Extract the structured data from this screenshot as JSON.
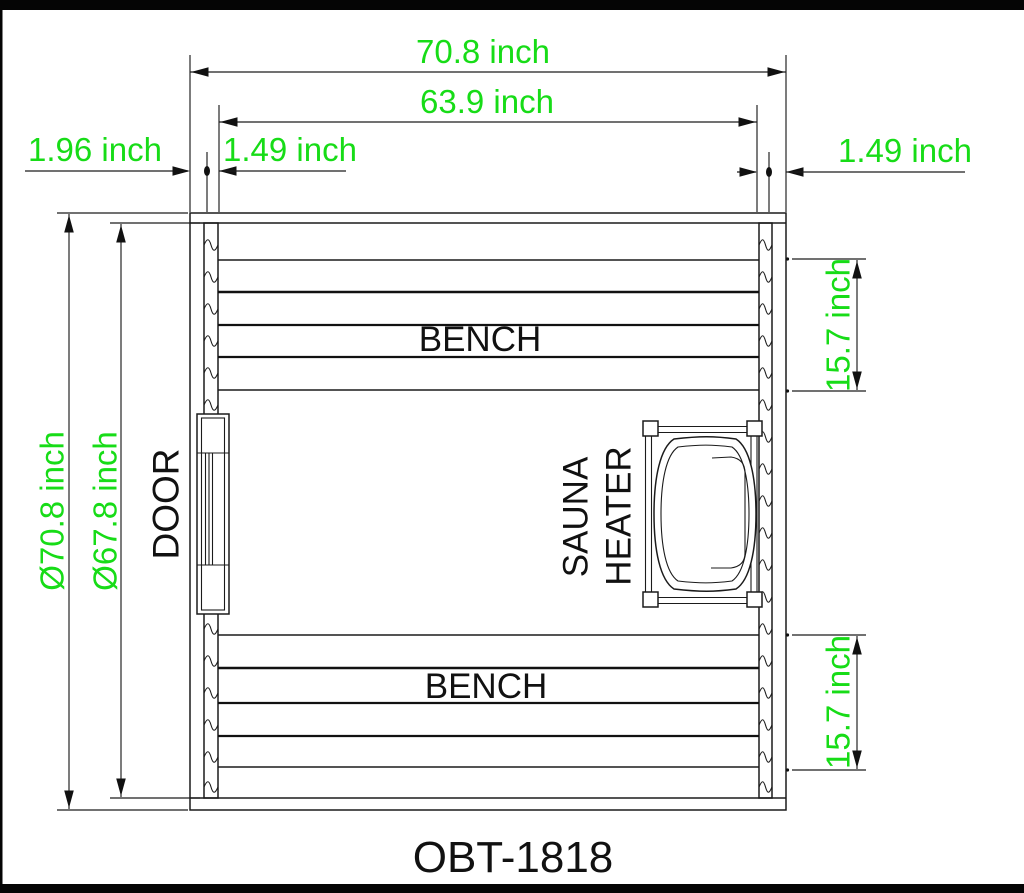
{
  "drawing": {
    "model": "OBT-1818",
    "unit": "inch",
    "colors": {
      "dimension_green": "#17DC17",
      "line_black": "#1B1B1B",
      "background": "#FFFFFF"
    },
    "dimensions": {
      "outer_width": "70.8 inch",
      "inner_width": "63.9 inch",
      "left_edge_offset": "1.96 inch",
      "left_inner_offset": "1.49 inch",
      "right_inner_offset": "1.49 inch",
      "outer_height": "Ø70.8 inch",
      "inner_height": "Ø67.8 inch",
      "top_bench_depth": "15.7 inch",
      "bottom_bench_depth": "15.7 inch"
    },
    "labels": {
      "top_bench": "BENCH",
      "bottom_bench": "BENCH",
      "door": "DOOR",
      "heater_line1": "SAUNA",
      "heater_line2": "HEATER"
    }
  }
}
